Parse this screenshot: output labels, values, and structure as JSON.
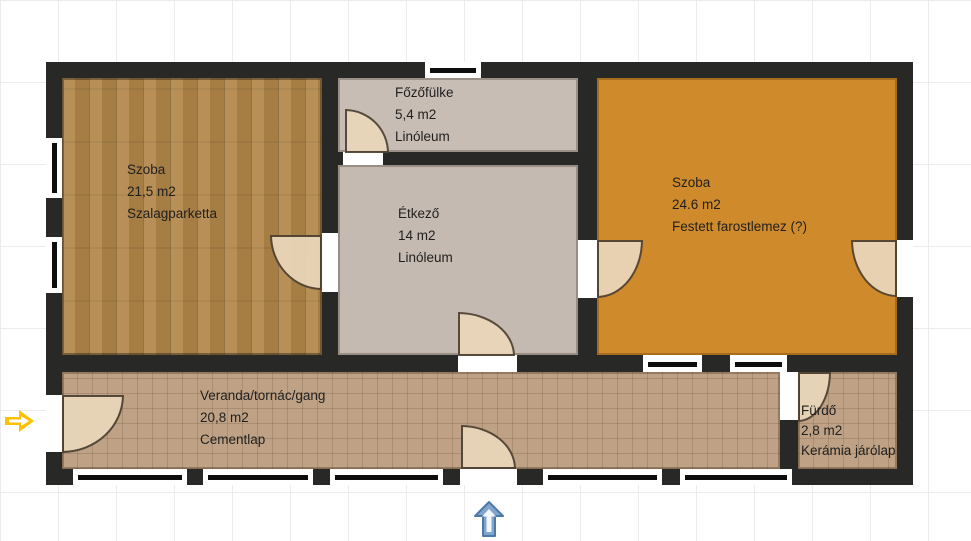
{
  "rooms": [
    {
      "name": "Szoba",
      "area": "21,5 m2",
      "floor": "Szalagparketta"
    },
    {
      "name": "Főzőfülke",
      "area": "5,4 m2",
      "floor": "Linóleum"
    },
    {
      "name": "Étkező",
      "area": "14 m2",
      "floor": "Linóleum"
    },
    {
      "name": "Szoba",
      "area": "24.6 m2",
      "floor": "Festett farostlemez (?)"
    },
    {
      "name": "Veranda/tornác/gang",
      "area": "20,8 m2",
      "floor": "Cementlap"
    },
    {
      "name": "Fürdő",
      "area": "2,8 m2",
      "floor": "Kerámia járólap"
    }
  ],
  "icons": [
    {
      "name": "entrance-arrow-icon",
      "direction": "right",
      "color": "#ffc000"
    },
    {
      "name": "direction-arrow-icon",
      "direction": "up",
      "color": "#7fa3c9"
    }
  ],
  "colors": {
    "wall": "#282826",
    "wood_floor": "#b28749",
    "linoleum": "#c8bdb5",
    "painted_fiberboard": "#cf8a2c",
    "cement_tile": "#bfa285",
    "door_swing": "#ead7ba",
    "yellow_arrow": "#ffc000",
    "blue_arrow": "#7fa3c9"
  }
}
